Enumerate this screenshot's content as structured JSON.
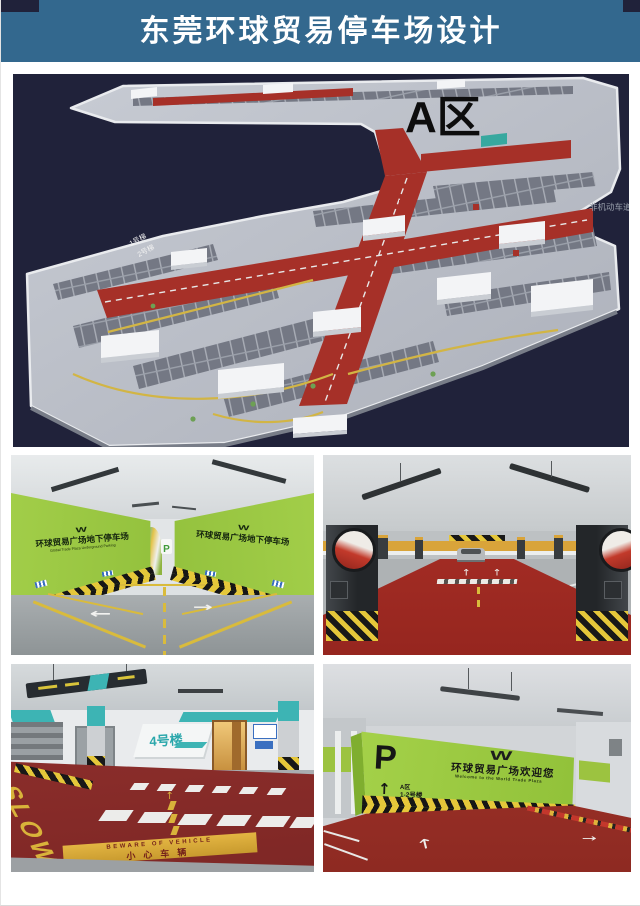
{
  "header": {
    "title": "东莞环球贸易停车场设计",
    "bg": "#33688e",
    "text_color": "#ffffff"
  },
  "colors": {
    "header_blue": "#33688e",
    "render_background": "#20223a",
    "road_red": "#a63028",
    "deck_gray": "#bfc3cb",
    "wall_green": "#96c63d",
    "floor_red": "#9e2b26",
    "floor_maroon": "#8c2f2d",
    "hazard_yellow": "#e5c73a",
    "teal_accent": "#3db4b4"
  },
  "render3d": {
    "zone_label": "A区",
    "side_label": "非机动车道",
    "deck_label_1": "1号梯",
    "deck_label_2": "2号梯"
  },
  "photos": {
    "ramp": {
      "logo_w": "W",
      "wall_text": "环球贸易广场地下停车场",
      "wall_subtext": "Global Trade Plaza Underground Parking",
      "p_sign": "P"
    },
    "crosswalk": {
      "slow_text": "SLOW",
      "banner_en": "BEWARE OF VEHICLE",
      "banner_cn": "小心车辆",
      "building_sign": "4号楼"
    },
    "welcome": {
      "p_sign": "P",
      "up_arrow": "↑",
      "zone_text": "A区",
      "building_text": "1-2号楼",
      "logo_w": "W",
      "title_cn": "环球贸易广场欢迎您",
      "title_en": "Welcome to the World Trade Plaza"
    }
  },
  "icons": {
    "left_arrow": "←",
    "right_arrow": "→",
    "up_arrow": "↑"
  }
}
